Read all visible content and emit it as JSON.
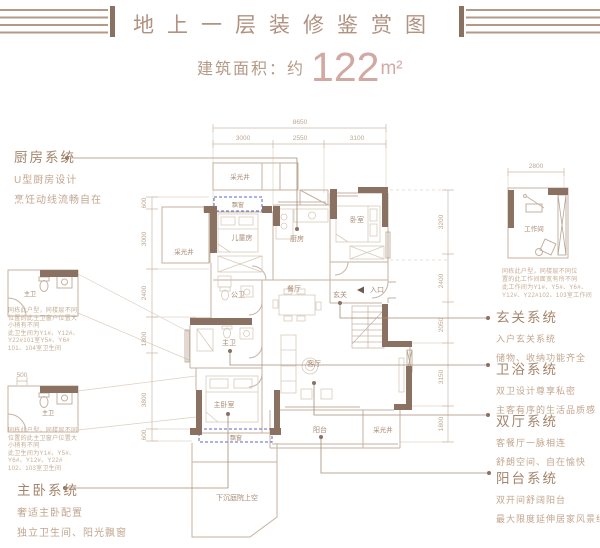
{
  "header": {
    "title": "地上一层装修鉴赏图",
    "area_label": "建筑面积：约",
    "area_value": "122",
    "area_unit": "m²"
  },
  "annotations": {
    "kitchen": {
      "title": "厨房系统",
      "lines": [
        "U型厨房设计",
        "烹饪动线流畅自在"
      ]
    },
    "master": {
      "title": "主卧系统",
      "lines": [
        "奢适主卧配置",
        "独立卫生间、阳光飘窗"
      ]
    },
    "right": [
      {
        "title": "玄关系统",
        "lines": [
          "入户玄关系统",
          "储物、收纳功能齐全"
        ]
      },
      {
        "title": "卫浴系统",
        "lines": [
          "双卫设计尊享私密",
          "主客有序的生活品质感"
        ]
      },
      {
        "title": "双厅系统",
        "lines": [
          "客餐厅一脉相连",
          "舒朗空间、自在愉快"
        ]
      },
      {
        "title": "阳台系统",
        "lines": [
          "双开间舒阔阳台",
          "最大限度延伸居家风景线"
        ]
      }
    ],
    "note_a": [
      "同栋此户型，同楼层不同",
      "位置的此主卫窗户位置大",
      "小稍有不同",
      "此卫生间为Y1#、Y12#、",
      "Y22#101室Y5#、Y6#",
      "101、104室卫生间"
    ],
    "note_b": [
      "同栋此户型，同楼层不同",
      "位置的此主卫窗户位置大",
      "小稍有不同",
      "此卫生间为Y1#、Y5#、",
      "Y6#、Y12#、Y22#",
      "102、103室卫生间"
    ],
    "note_work": [
      "同栋此户型，同楼层不同位",
      "置的此工作间面宽有所不同",
      "此工作间为Y1#、Y5#、Y6#、",
      "Y12#、Y22#102、103室工作间"
    ]
  },
  "floor_plan": {
    "room_labels": [
      {
        "label": "采光井",
        "x": 240,
        "y": 179,
        "size": 6.5
      },
      {
        "label": "采光井",
        "x": 184,
        "y": 254,
        "size": 6.5
      },
      {
        "label": "飘窗",
        "x": 238,
        "y": 207,
        "size": 6
      },
      {
        "label": "儿童房",
        "x": 242,
        "y": 240
      },
      {
        "label": "厨房",
        "x": 297,
        "y": 241
      },
      {
        "label": "卧室",
        "x": 357,
        "y": 222
      },
      {
        "label": "公卫",
        "x": 238,
        "y": 297
      },
      {
        "label": "主卫",
        "x": 229,
        "y": 345
      },
      {
        "label": "餐厅",
        "x": 294,
        "y": 291
      },
      {
        "label": "玄关",
        "x": 340,
        "y": 297
      },
      {
        "label": "入口",
        "x": 377,
        "y": 292
      },
      {
        "label": "客厅",
        "x": 314,
        "y": 366
      },
      {
        "label": "主卧室",
        "x": 224,
        "y": 407
      },
      {
        "label": "飘窗",
        "x": 236,
        "y": 440,
        "size": 6
      },
      {
        "label": "阳台",
        "x": 320,
        "y": 432
      },
      {
        "label": "采光井",
        "x": 383,
        "y": 432,
        "size": 6.5
      },
      {
        "label": "下沉庭院上空",
        "x": 237,
        "y": 500
      },
      {
        "label": "工作间",
        "x": 534,
        "y": 231,
        "size": 6.5
      },
      {
        "label": "主卫",
        "x": 30,
        "y": 296,
        "size": 6
      },
      {
        "label": "主卫",
        "x": 48,
        "y": 415,
        "size": 6
      }
    ],
    "dim_labels": [
      {
        "text": "8650",
        "x": 300,
        "y": 124
      },
      {
        "text": "3000",
        "x": 243,
        "y": 140
      },
      {
        "text": "2550",
        "x": 300,
        "y": 140
      },
      {
        "text": "3100",
        "x": 357,
        "y": 140
      },
      {
        "text": "2800",
        "x": 536,
        "y": 168
      },
      {
        "text": "500",
        "x": 22,
        "y": 377
      },
      {
        "text": "600",
        "x": 146,
        "y": 203,
        "rot": -90
      },
      {
        "text": "3000",
        "x": 146,
        "y": 239,
        "rot": -90
      },
      {
        "text": "2400",
        "x": 146,
        "y": 293,
        "rot": -90
      },
      {
        "text": "1800",
        "x": 146,
        "y": 339,
        "rot": -90
      },
      {
        "text": "3800",
        "x": 146,
        "y": 400,
        "rot": -90
      },
      {
        "text": "600",
        "x": 146,
        "y": 435,
        "rot": -90
      },
      {
        "text": "3200",
        "x": 443,
        "y": 222,
        "rot": -90
      },
      {
        "text": "2400",
        "x": 443,
        "y": 281,
        "rot": -90
      },
      {
        "text": "2050",
        "x": 443,
        "y": 325,
        "rot": -90
      },
      {
        "text": "3150",
        "x": 443,
        "y": 377,
        "rot": -90
      },
      {
        "text": "1800",
        "x": 443,
        "y": 424,
        "rot": -90
      }
    ]
  }
}
